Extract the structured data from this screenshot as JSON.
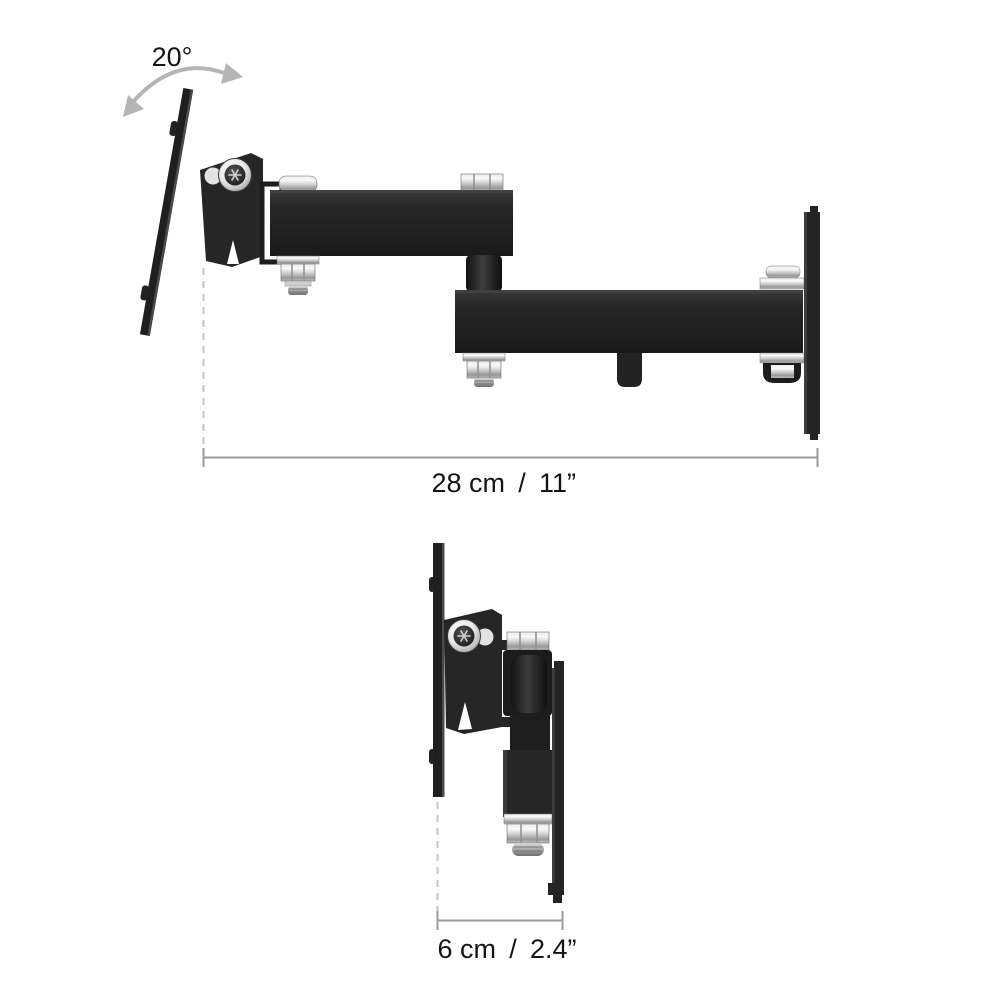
{
  "diagram": {
    "kind": "product-dimension-diagram",
    "subject": "articulating-tv-wall-mount-bracket",
    "background_color": "#ffffff",
    "annotations": {
      "tilt_angle": "20°",
      "top_view_dimension": {
        "metric": "28 cm",
        "separator": "/",
        "imperial": "11”",
        "full_text": "28 cm / 11”"
      },
      "side_view_dimension": {
        "metric": "6 cm",
        "separator": "/",
        "imperial": "2.4”",
        "full_text": "6 cm / 2.4”"
      }
    },
    "views": {
      "top": {
        "description": "top view, arm extended, tilt range arrow"
      },
      "side": {
        "description": "side profile view, arm folded"
      }
    },
    "colors": {
      "metal_black": "#242424",
      "chrome_light": "#f2f2f2",
      "chrome_dark": "#9a9a9a",
      "dimension_line": "#9b9b9b",
      "extension_dash": "#c4c4c4",
      "arrow_gray": "#b5b5b5",
      "text": "#141414"
    }
  }
}
